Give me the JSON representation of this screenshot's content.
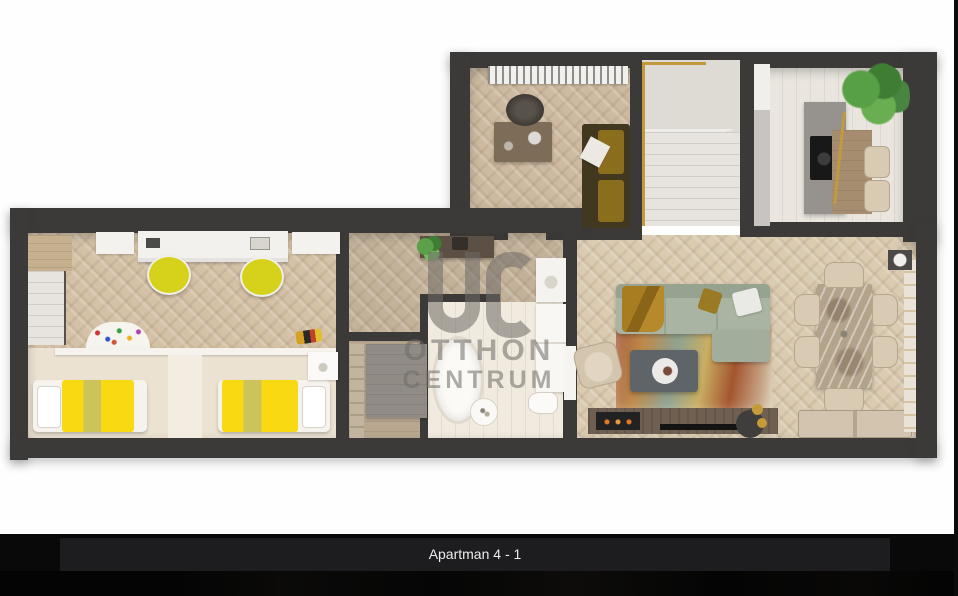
{
  "caption": {
    "label": "Apartman 4 - 1"
  },
  "watermark": {
    "logo": "OC",
    "line1": "OTTHON",
    "line2": "CENTRUM"
  },
  "colors": {
    "background": "#fefefe",
    "wall": "#3b3a38",
    "caption_bar": "#1d1d1f",
    "caption_text": "#ededed",
    "watermark_gray": "#6e6b66",
    "bed_yellow": "#f8da12",
    "desk_chair_yellow": "#d6d21c",
    "sofa_sage": "#a9b5a2",
    "office_sofa_gold": "#8a6d1d",
    "accent_gold": "#c59a38",
    "plant_green": "#4e8c3e",
    "floor_wood_light": "#d9cbb1",
    "floor_wood_mid": "#cdbaa0",
    "bathroom_floor": "#f0eadf"
  }
}
